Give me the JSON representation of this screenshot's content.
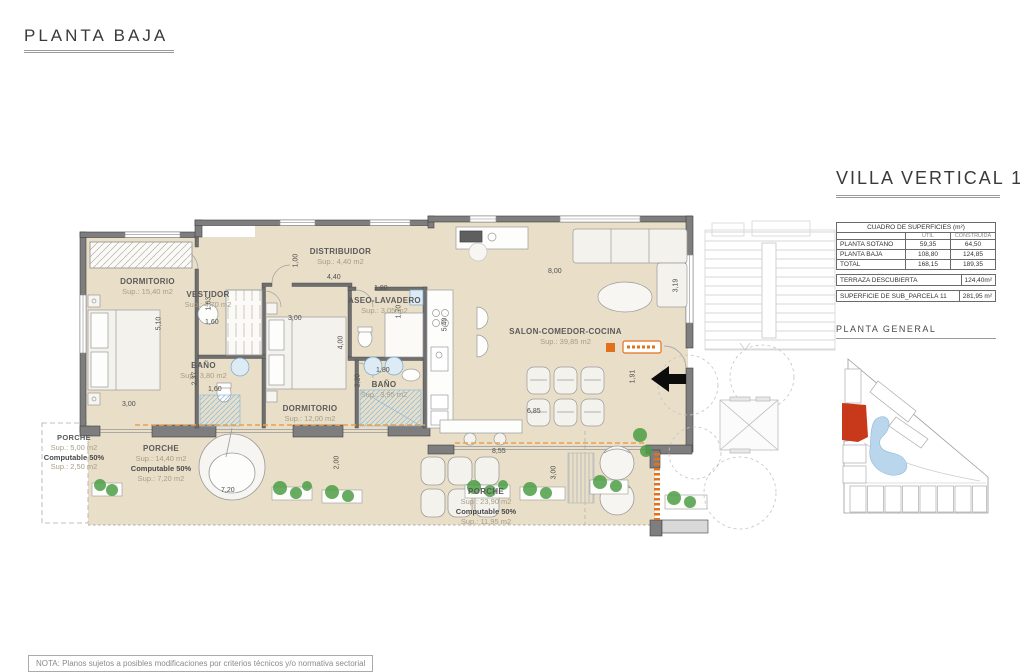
{
  "page_title": "PLANTA BAJA",
  "panel": {
    "title": "VILLA VERTICAL 11",
    "table": {
      "title": "CUADRO DE SUPERFICIES (m²)",
      "col_util": "UTIL",
      "col_construida": "CONSTRUIDA",
      "rows": [
        {
          "label": "PLANTA SOTANO",
          "util": "59,35",
          "construida": "64,50"
        },
        {
          "label": "PLANTA BAJA",
          "util": "108,80",
          "construida": "124,85"
        },
        {
          "label": "TOTAL",
          "util": "168,15",
          "construida": "189,35"
        }
      ],
      "terraza_label": "TERRAZA DESCUBIERTA",
      "terraza_value": "124,40m²",
      "parcela_label": "SUPERFICIE DE SUB_PARCELA 11",
      "parcela_value": "281,95 m²"
    },
    "planta_general_label": "PLANTA GENERAL"
  },
  "rooms": {
    "dormitorio1": {
      "name": "DORMITORIO",
      "sup": "Sup.: 15,40  m2"
    },
    "vestidor": {
      "name": "VESTIDOR",
      "sup": "Sup.: 4,70  m2"
    },
    "distribuidor": {
      "name": "DISTRIBUIDOR",
      "sup": "Sup.: 4,40  m2"
    },
    "aseo": {
      "name": "ASEO-LAVADERO",
      "sup": "Sup.: 3,05  m2"
    },
    "banio1": {
      "name": "BAÑO",
      "sup": "Sup.: 3,80  m2"
    },
    "dormitorio2": {
      "name": "DORMITORIO",
      "sup": "Sup.: 12,00  m2"
    },
    "banio2": {
      "name": "BAÑO",
      "sup": "Sup.: 3,95  m2"
    },
    "salon": {
      "name": "SALON-COMEDOR-COCINA",
      "sup": "Sup.: 39,85  m2"
    },
    "porche_ext": {
      "name": "PORCHE",
      "sup": "Sup.: 5,00  m2",
      "comp": "Computable 50%",
      "comp_sup": "Sup.: 2,50  m2"
    },
    "porche_izq": {
      "name": "PORCHE",
      "sup": "Sup.: 14,40  m2",
      "comp": "Computable 50%",
      "comp_sup": "Sup.: 7,20  m2"
    },
    "porche_ppal": {
      "name": "PORCHE",
      "sup": "Sup.: 23,90  m2",
      "comp": "Computable 50%",
      "comp_sup": "Sup.: 11,95  m2"
    }
  },
  "dims": {
    "d510": "5,10",
    "d300a": "3,00",
    "d163": "1,63",
    "d160a": "1,60",
    "d237": "2,37",
    "d160b": "1,60",
    "d100": "1,00",
    "d440": "4,40",
    "d300b": "3,00",
    "d180a": "1,80",
    "d170": "1,70",
    "d540": "5,40",
    "d400": "4,00",
    "d180b": "1,80",
    "d220": "2,20",
    "d800": "8,00",
    "d319": "3,19",
    "d685": "6,85",
    "d191": "1,91",
    "d855": "8,55",
    "d300c": "3,00",
    "d720": "7,20",
    "d200": "2,00"
  },
  "note": "NOTA: Planos sujetos a posibles modificaciones por criterios técnicos y/o normativa sectorial",
  "colors": {
    "floor_beige": "#e9dfc9",
    "wall_gray": "#7e7e7e",
    "accent_orange": "#e2711d",
    "parcel_red": "#c8391b",
    "water_blue": "#b9d6ec",
    "plant_green": "#4d9e45"
  }
}
